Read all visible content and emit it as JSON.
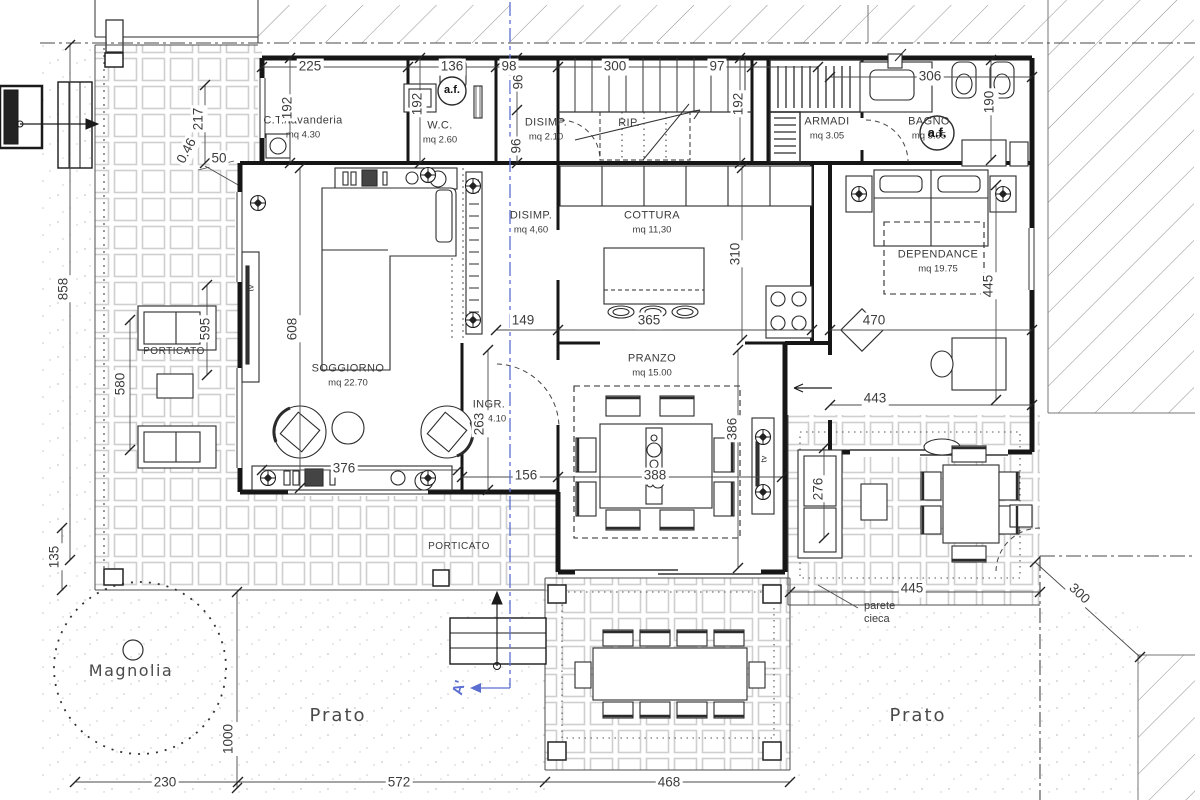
{
  "drawing": {
    "type": "architectural floor plan",
    "language": "it"
  },
  "colors": {
    "line": "#1a1a1a",
    "tile": "#cfcfcf",
    "hatch": "#8f8f8f",
    "section_line": "#5b6ed1",
    "text": "#3b3b3b"
  },
  "rooms": {
    "ct": {
      "name": "C.T./lavanderia",
      "area": "mq 4.30"
    },
    "wc": {
      "name": "W.C.",
      "area": "mq 2.60"
    },
    "disimp1": {
      "name": "DISIMP.",
      "area": "mq 2.10"
    },
    "rip": {
      "name": "RIP."
    },
    "armadi": {
      "name": "ARMADI",
      "area": "mq 3.05"
    },
    "bagno": {
      "name": "BAGNO",
      "area": "mq 5.95"
    },
    "disimp2": {
      "name": "DISIMP.",
      "area": "mq 4,60"
    },
    "cottura": {
      "name": "COTTURA",
      "area": "mq 11,30"
    },
    "dependance": {
      "name": "DEPENDANCE",
      "area": "mq 19.75"
    },
    "soggiorno": {
      "name": "SOGGIORNO",
      "area": "mq 22.70"
    },
    "ingr": {
      "name": "INGR.",
      "area": "mq 4.10"
    },
    "pranzo": {
      "name": "PRANZO",
      "area": "mq 15.00"
    }
  },
  "outdoor": {
    "porticato": "PORTICATO",
    "prato": "Prato",
    "magnolia": "Magnolia",
    "parete_cieca": "parete cieca"
  },
  "annotations": {
    "tv": "tv",
    "af": "a.f.",
    "section": "A'"
  },
  "dims": {
    "d225": "225",
    "d136": "136",
    "d98": "98",
    "d300s": "300",
    "d97": "97",
    "d306": "306",
    "d192a": "192",
    "d192b": "192",
    "d96a": "96",
    "d96b": "96",
    "d192c": "192",
    "d190": "190",
    "d217": "217",
    "d50": "50",
    "d046": "0.46",
    "d858": "858",
    "d595": "595",
    "d580": "580",
    "d135": "135",
    "d1000": "1000",
    "d608": "608",
    "d310": "310",
    "d149": "149",
    "d365": "365",
    "d470": "470",
    "d443": "443",
    "d445v": "445",
    "d263": "263",
    "d156": "156",
    "d376": "376",
    "d388": "388",
    "d386": "386",
    "d276": "276",
    "d445h": "445",
    "d300d": "300",
    "d230": "230",
    "d572": "572",
    "d468": "468"
  }
}
